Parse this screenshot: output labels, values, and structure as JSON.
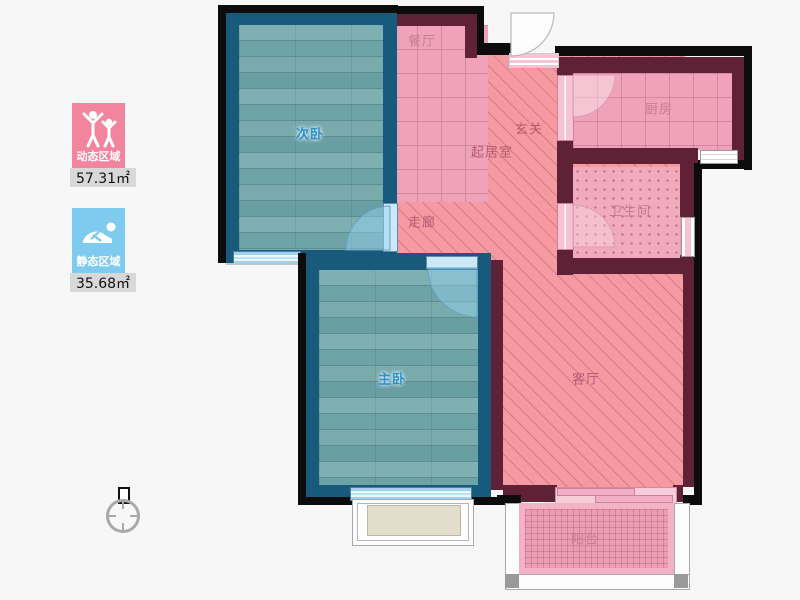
{
  "legend": {
    "dynamic": {
      "label": "动态区域",
      "value": "57.31㎡"
    },
    "static": {
      "label": "静态区域",
      "value": "35.68㎡"
    }
  },
  "rooms": {
    "secondary_bedroom": "次卧",
    "dining": "餐厅",
    "entry": "玄关",
    "living_core": "起居室",
    "corridor": "走廊",
    "kitchen": "厨房",
    "bathroom": "卫生间",
    "master_bedroom": "主卧",
    "living_room": "客厅",
    "balcony": "阳台"
  },
  "colors": {
    "legend_pink": "#f2849e",
    "legend_blue": "#7fcbf0",
    "wall_bedroom_blue": "#175a7b",
    "wall_main_maroon": "#5f2136",
    "wall_outline_black": "#0c0c0c",
    "floor_wood_teal": "#74a7ab",
    "floor_tile_pink": "#efa2b9",
    "floor_hatch_salmon": "#f59aa2",
    "floor_balcony_pink": "#eb9eb3",
    "window_blue": "#a5d6f0"
  }
}
